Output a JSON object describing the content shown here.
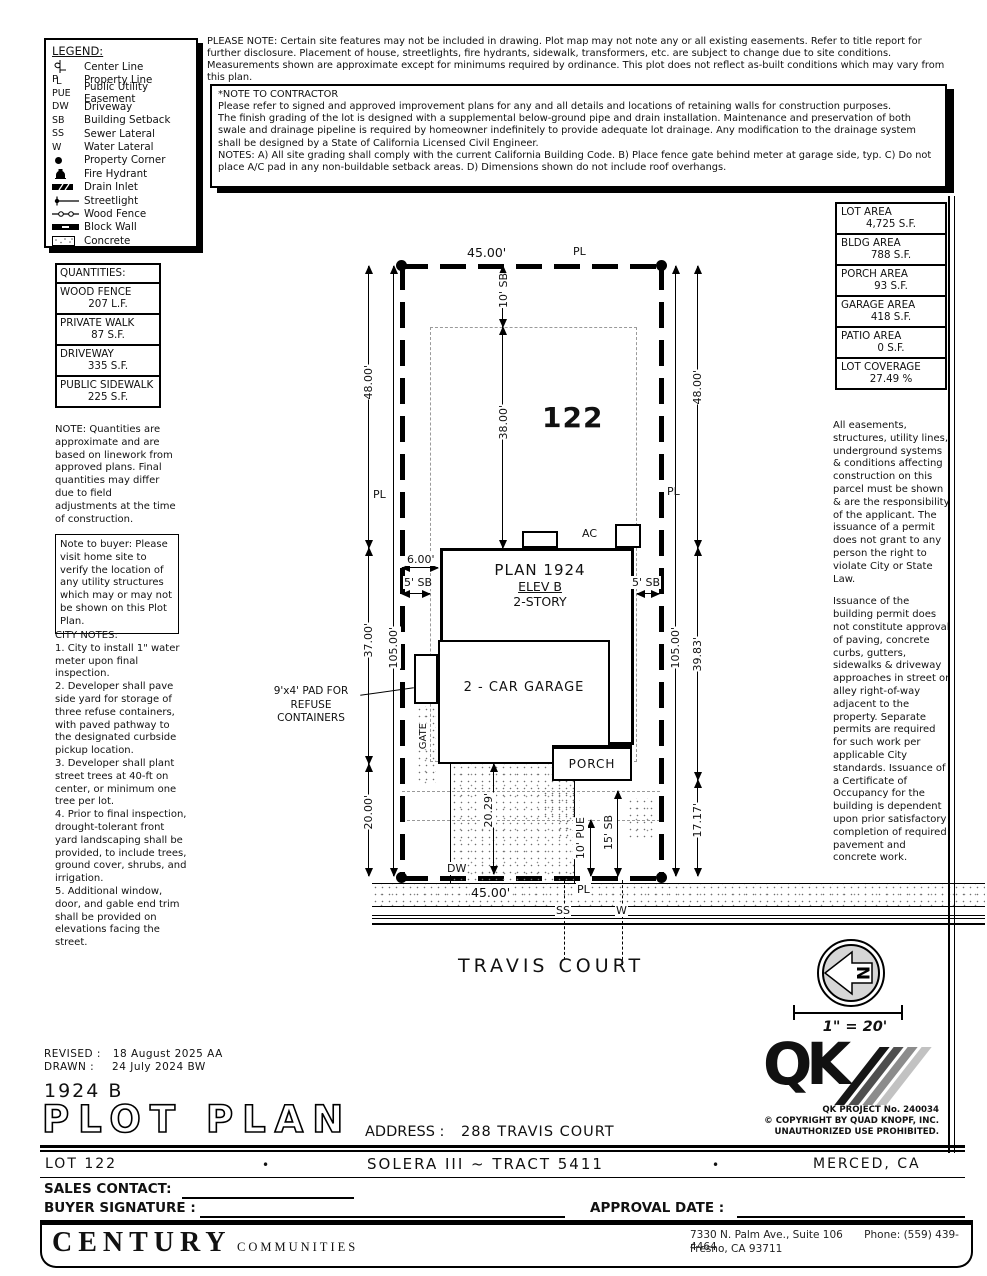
{
  "doc": {
    "please_note": "PLEASE NOTE:  Certain site features may not be included in drawing.  Plot map may not note any or all existing easements. Refer to title report for further disclosure.  Placement of house, streetlights, fire hydrants, sidewalk, transformers, etc. are subject to change due to site conditions.  Measurements shown are approximate except for minimums required by ordinance.  This plot does not reflect as-built conditions which may vary from this plan."
  },
  "legend": {
    "title": "LEGEND:",
    "items": [
      {
        "sym": "centerline-symbol",
        "label": "Center Line"
      },
      {
        "sym": "property-line-symbol",
        "label": "Property Line"
      },
      {
        "sym": "PUE",
        "label": "Public Utility Easement"
      },
      {
        "sym": "DW",
        "label": "Driveway"
      },
      {
        "sym": "SB",
        "label": "Building Setback"
      },
      {
        "sym": "SS",
        "label": "Sewer Lateral"
      },
      {
        "sym": "W",
        "label": "Water Lateral"
      },
      {
        "sym": "property-corner-symbol",
        "label": "Property Corner"
      },
      {
        "sym": "fire-hydrant-symbol",
        "label": "Fire Hydrant"
      },
      {
        "sym": "drain-inlet-symbol",
        "label": "Drain Inlet"
      },
      {
        "sym": "streetlight-symbol",
        "label": "Streetlight"
      },
      {
        "sym": "wood-fence-symbol",
        "label": "Wood Fence"
      },
      {
        "sym": "block-wall-symbol",
        "label": "Block Wall"
      },
      {
        "sym": "concrete-symbol",
        "label": "Concrete"
      }
    ]
  },
  "contractor_note": {
    "title": "*NOTE TO CONTRACTOR",
    "line1": "Please refer to signed and approved improvement plans for any and all details and locations of retaining walls for construction purposes.",
    "line2": "The finish grading of the lot is designed with a supplemental below-ground pipe and drain installation.  Maintenance and preservation of both swale and drainage pipeline is required by homeowner indefinitely to provide adequate lot drainage.  Any modification to the drainage system shall be designed by a State of California Licensed Civil Engineer.",
    "line3": "NOTES:  A) All site grading shall comply with the current California Building Code.  B) Place fence gate behind meter at garage side, typ.  C) Do not place A/C pad in any non-buildable setback areas.  D) Dimensions shown do not include roof overhangs."
  },
  "quantities": {
    "title": "QUANTITIES:",
    "rows": [
      {
        "name": "WOOD FENCE",
        "value": "207 L.F."
      },
      {
        "name": "PRIVATE WALK",
        "value": "87 S.F."
      },
      {
        "name": "DRIVEWAY",
        "value": "335 S.F."
      },
      {
        "name": "PUBLIC SIDEWALK",
        "value": "225 S.F."
      }
    ],
    "note": "NOTE: Quantities are approximate and are based on linework from approved plans.  Final quantities may differ due to field adjustments at the time of construction."
  },
  "buyer_note": "Note to buyer: Please visit home site to verify the location of any utility structures which may or may not be shown on this Plot Plan.",
  "city_notes": {
    "title": "CITY NOTES:",
    "items": [
      "1. City to install 1\" water meter upon final inspection.",
      "2. Developer shall pave side yard for storage of three refuse containers, with paved pathway to the designated curbside pickup location.",
      "3. Developer shall plant street trees at 40-ft on center, or minimum one tree per lot.",
      "4. Prior to final inspection, drought-tolerant front yard landscaping shall be provided, to include trees, ground cover, shrubs, and irrigation.",
      "5. Additional window, door, and gable end trim shall be provided on elevations facing the street."
    ]
  },
  "areas": {
    "rows": [
      {
        "name": "LOT AREA",
        "value": "4,725 S.F."
      },
      {
        "name": "BLDG AREA",
        "value": "788 S.F."
      },
      {
        "name": "PORCH AREA",
        "value": "93 S.F."
      },
      {
        "name": "GARAGE AREA",
        "value": "418 S.F."
      },
      {
        "name": "PATIO AREA",
        "value": "0 S.F."
      },
      {
        "name": "LOT COVERAGE",
        "value": "27.49 %"
      }
    ]
  },
  "right_notes": {
    "para1": "All easements, structures, utility lines, underground systems & conditions affecting construction on this parcel must be shown & are the responsibility of the applicant. The issuance of a permit does not grant to any person the right to violate City or State Law.",
    "para2": "Issuance of the building permit does not constitute approval of paving, concrete curbs, gutters, sidewalks & driveway approaches in street or alley right-of-way adjacent to the property. Separate permits are required for such work per applicable City standards. Issuance of a Certificate of Occupancy for the building is dependent upon prior satisfactory completion of required pavement and concrete work."
  },
  "plot": {
    "lot_number": "122",
    "house": {
      "plan": "PLAN 1924",
      "elev": "ELEV B",
      "story": "2-STORY",
      "garage": "2 - CAR GARAGE",
      "porch": "PORCH"
    },
    "refuse_pad_note": "9'x4' PAD FOR REFUSE CONTAINERS",
    "street_name": "TRAVIS COURT",
    "dims": {
      "width_front": "45.00'",
      "width_rear": "45.00'",
      "front_setback": "10' SB",
      "front_to_house": "38.00'",
      "left_front": "48.00'",
      "left_mid": "37.00'",
      "left_rear": "20.00'",
      "left_total": "105.00'",
      "right_front": "48.00'",
      "right_mid": "39.83'",
      "right_rear": "17.17'",
      "right_total": "105.00'",
      "pad_offset": "6.00'",
      "side_sb_left": "5' SB",
      "side_sb_right": "5' SB",
      "driveway_depth": "20.29'",
      "pue": "10' PUE",
      "rear_sb": "15' SB"
    },
    "labels": {
      "pl": "PL",
      "dw": "DW",
      "ss": "SS",
      "w": "W",
      "ac": "AC",
      "gate": "GATE"
    }
  },
  "north_arrow": {
    "letter": "N",
    "scale": "1\" = 20'"
  },
  "qk": {
    "logo": "QK",
    "project": "QK PROJECT No. 240034",
    "copyright": "© COPYRIGHT BY QUAD KNOPF, INC.",
    "unauthorized": "UNAUTHORIZED USE PROHIBITED."
  },
  "titleblock": {
    "revised_label": "REVISED :",
    "revised": "18 August 2025  AA",
    "drawn_label": "DRAWN :",
    "drawn": "24 July 2024  BW",
    "plan_code": "1924  B",
    "title": "PLOT PLAN",
    "address_label": "ADDRESS :",
    "address": "288 TRAVIS COURT"
  },
  "footer": {
    "lot": "LOT 122",
    "bullet": "•",
    "tract": "SOLERA III ~ TRACT 5411",
    "city": "MERCED, CA",
    "sales_label": "SALES CONTACT:",
    "signature_label": "BUYER SIGNATURE :",
    "approval_label": "APPROVAL DATE :",
    "brand_name": "CENTURY",
    "brand_sub": "COMMUNITIES",
    "office_line1": "7330 N. Palm Ave., Suite 106",
    "office_phone": "Phone:  (559) 439-4464",
    "office_line2": "Fresno, CA  93711"
  }
}
